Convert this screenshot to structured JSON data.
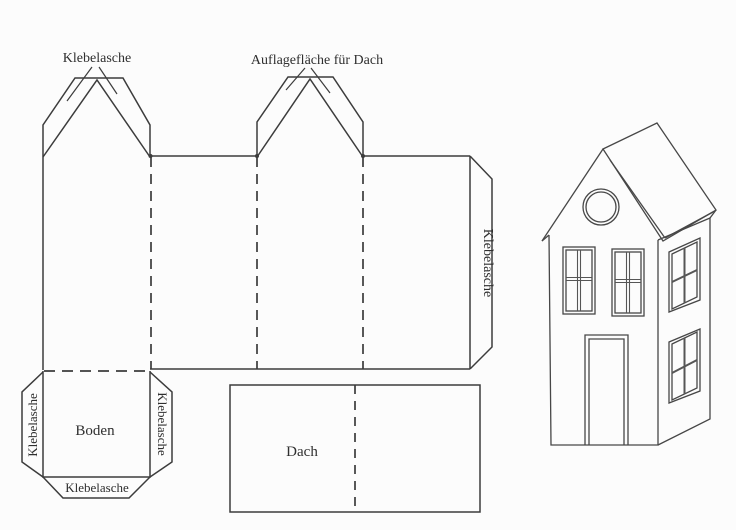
{
  "template": {
    "label_top_left": "Klebelasche",
    "label_top_middle": "Auflagefläche für Dach",
    "label_side_tab": "Klebelasche",
    "floor": {
      "label": "Boden",
      "tab_left": "Klebelasche",
      "tab_right": "Klebelasche",
      "tab_bottom": "Klebelasche"
    },
    "roof": {
      "label": "Dach"
    }
  },
  "colors": {
    "ink": "#3c3c3c",
    "house_ink": "#474747",
    "mullion": "#565656",
    "background": "#fcfcfc"
  }
}
